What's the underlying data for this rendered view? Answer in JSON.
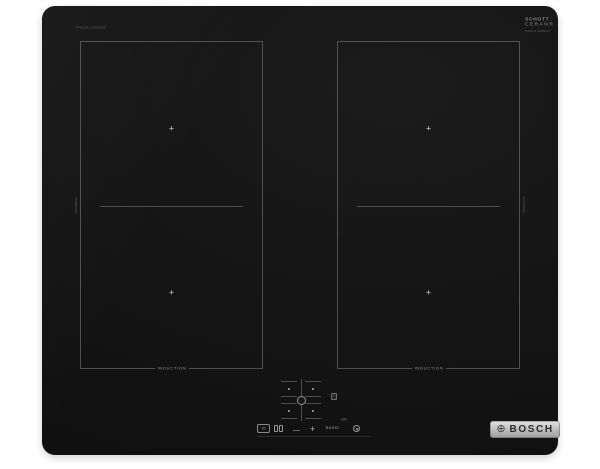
{
  "product": {
    "model_label": "PVQ611BB5E",
    "brand_name": "BOSCH",
    "brand_symbol": "⊕"
  },
  "glass_logo": {
    "line1": "SCHOTT",
    "line2": "CERAN®",
    "subline": "MADE IN GERMANY"
  },
  "zones": {
    "cross": "+",
    "induction_label": "INDUCTION",
    "side_label": "combiZone"
  },
  "controls": {
    "power_label": "I0",
    "minus_label": "—",
    "plus_label": "+",
    "boost_label": "boost",
    "min_label": "min"
  },
  "colors": {
    "background": "#ffffff",
    "glass_black": "#161616",
    "zone_line_gray": "#828282",
    "print_gray": "#9a9a9a",
    "logo_silver": "#c2c2c2"
  }
}
